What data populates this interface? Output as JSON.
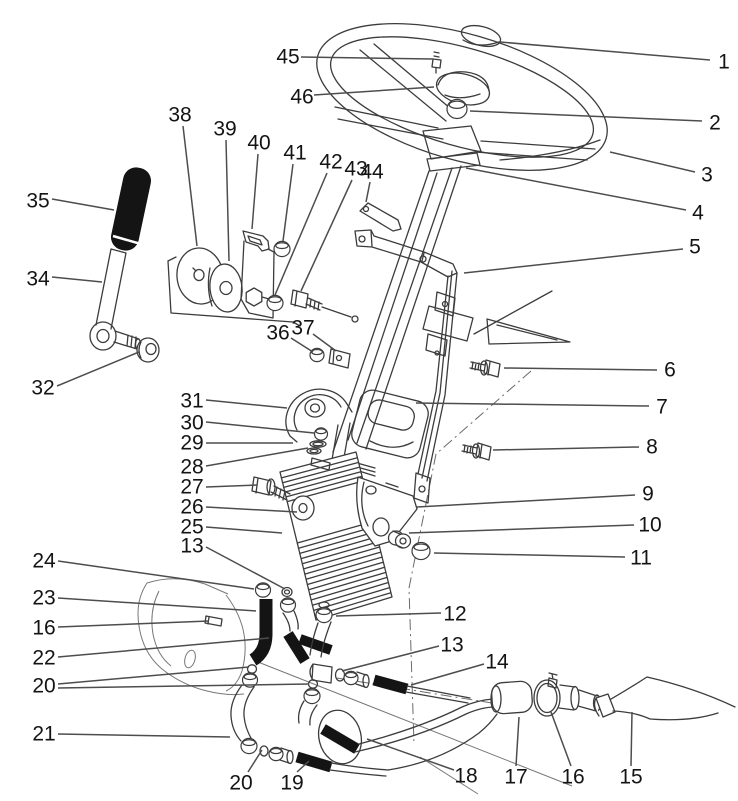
{
  "figure": {
    "type": "exploded-parts-diagram",
    "subject": "steering tower: steering wheel, tilt steering column, control valve and hydraulic hoses",
    "background": "#ffffff",
    "line_color": "#3c3c3c",
    "leader_color": "#4d4d4d",
    "label_color": "#141414",
    "ink_color": "#141414",
    "label_font_size": 21
  },
  "callouts": [
    {
      "label": "1",
      "x": 724,
      "y": 62,
      "leaders": [
        [
          500,
          42,
          710,
          60
        ]
      ]
    },
    {
      "label": "2",
      "x": 715,
      "y": 123,
      "leaders": [
        [
          470,
          111,
          702,
          121
        ]
      ]
    },
    {
      "label": "3",
      "x": 707,
      "y": 175,
      "leaders": [
        [
          610,
          152,
          695,
          172
        ]
      ]
    },
    {
      "label": "4",
      "x": 698,
      "y": 213,
      "leaders": [
        [
          466,
          168,
          686,
          210
        ]
      ]
    },
    {
      "label": "5",
      "x": 695,
      "y": 247,
      "leaders": [
        [
          464,
          273,
          683,
          249
        ]
      ]
    },
    {
      "label": "6",
      "x": 670,
      "y": 370,
      "leaders": [
        [
          504,
          368,
          657,
          370
        ]
      ]
    },
    {
      "label": "7",
      "x": 662,
      "y": 407,
      "leaders": [
        [
          416,
          403,
          649,
          406
        ]
      ]
    },
    {
      "label": "8",
      "x": 652,
      "y": 447,
      "leaders": [
        [
          493,
          450,
          639,
          447
        ]
      ]
    },
    {
      "label": "9",
      "x": 648,
      "y": 494,
      "leaders": [
        [
          417,
          507,
          635,
          495
        ]
      ]
    },
    {
      "label": "10",
      "x": 650,
      "y": 525,
      "leaders": [
        [
          409,
          533,
          634,
          525
        ]
      ]
    },
    {
      "label": "11",
      "x": 641,
      "y": 558,
      "leaders": [
        [
          434,
          553,
          625,
          557
        ]
      ]
    },
    {
      "label": "12",
      "x": 455,
      "y": 614,
      "leaders": [
        [
          336,
          616,
          441,
          613
        ]
      ]
    },
    {
      "label": "13",
      "x": 452,
      "y": 645,
      "leaders": [
        [
          342,
          671,
          439,
          646
        ]
      ]
    },
    {
      "label": "14",
      "x": 497,
      "y": 662,
      "leaders": [
        [
          411,
          685,
          484,
          664
        ]
      ]
    },
    {
      "label": "15",
      "x": 631,
      "y": 777,
      "leaders": [
        [
          632,
          712,
          631,
          766
        ]
      ]
    },
    {
      "label": "16",
      "x": 573,
      "y": 777,
      "leaders": [
        [
          551,
          712,
          571,
          766
        ]
      ]
    },
    {
      "label": "17",
      "x": 516,
      "y": 777,
      "leaders": [
        [
          519,
          717,
          516,
          766
        ]
      ]
    },
    {
      "label": "18",
      "x": 466,
      "y": 776,
      "leaders": [
        [
          367,
          739,
          454,
          770
        ]
      ]
    },
    {
      "label": "19",
      "x": 292,
      "y": 783,
      "leaders": [
        [
          309,
          761,
          297,
          772
        ]
      ]
    },
    {
      "label": "20",
      "x": 241,
      "y": 783,
      "leaders": [
        [
          262,
          750,
          248,
          772
        ]
      ]
    },
    {
      "label": "21",
      "x": 44,
      "y": 734,
      "leaders": [
        [
          230,
          737,
          58,
          734
        ]
      ]
    },
    {
      "label": "20",
      "x": 44,
      "y": 686,
      "leaders": [
        [
          249,
          667,
          58,
          684
        ],
        [
          309,
          684,
          58,
          688
        ]
      ]
    },
    {
      "label": "22",
      "x": 44,
      "y": 658,
      "leaders": [
        [
          269,
          638,
          58,
          657
        ]
      ]
    },
    {
      "label": "16",
      "x": 44,
      "y": 628,
      "leaders": [
        [
          209,
          621,
          58,
          627
        ]
      ]
    },
    {
      "label": "23",
      "x": 44,
      "y": 598,
      "leaders": [
        [
          256,
          611,
          58,
          598
        ]
      ]
    },
    {
      "label": "24",
      "x": 44,
      "y": 561,
      "leaders": [
        [
          254,
          589,
          58,
          561
        ]
      ]
    },
    {
      "label": "13",
      "x": 192,
      "y": 546,
      "leaders": [
        [
          285,
          589,
          206,
          547
        ]
      ]
    },
    {
      "label": "25",
      "x": 192,
      "y": 527,
      "leaders": [
        [
          282,
          533,
          206,
          527
        ]
      ]
    },
    {
      "label": "26",
      "x": 192,
      "y": 507,
      "leaders": [
        [
          297,
          512,
          206,
          507
        ]
      ]
    },
    {
      "label": "27",
      "x": 192,
      "y": 487,
      "leaders": [
        [
          257,
          485,
          206,
          487
        ]
      ]
    },
    {
      "label": "28",
      "x": 192,
      "y": 467,
      "leaders": [
        [
          308,
          448,
          206,
          466
        ]
      ]
    },
    {
      "label": "29",
      "x": 192,
      "y": 443,
      "leaders": [
        [
          293,
          443,
          206,
          443
        ]
      ]
    },
    {
      "label": "30",
      "x": 192,
      "y": 423,
      "leaders": [
        [
          314,
          433,
          206,
          422
        ]
      ]
    },
    {
      "label": "31",
      "x": 192,
      "y": 401,
      "leaders": [
        [
          287,
          408,
          206,
          400
        ]
      ]
    },
    {
      "label": "32",
      "x": 43,
      "y": 388,
      "leaders": [
        [
          139,
          352,
          57,
          386
        ]
      ]
    },
    {
      "label": "34",
      "x": 38,
      "y": 279,
      "leaders": [
        [
          102,
          282,
          52,
          277
        ]
      ]
    },
    {
      "label": "35",
      "x": 38,
      "y": 201,
      "leaders": [
        [
          114,
          210,
          52,
          199
        ]
      ]
    },
    {
      "label": "36",
      "x": 278,
      "y": 333,
      "leaders": [
        [
          313,
          352,
          291,
          338
        ]
      ]
    },
    {
      "label": "37",
      "x": 303,
      "y": 328,
      "leaders": [
        [
          336,
          351,
          313,
          334
        ]
      ]
    },
    {
      "label": "38",
      "x": 180,
      "y": 115,
      "leaders": [
        [
          197,
          246,
          183,
          126
        ]
      ]
    },
    {
      "label": "39",
      "x": 225,
      "y": 129,
      "leaders": [
        [
          229,
          261,
          226,
          140
        ]
      ]
    },
    {
      "label": "40",
      "x": 259,
      "y": 143,
      "leaders": [
        [
          252,
          229,
          258,
          154
        ]
      ]
    },
    {
      "label": "41",
      "x": 295,
      "y": 153,
      "leaders": [
        [
          283,
          241,
          293,
          164
        ]
      ]
    },
    {
      "label": "42",
      "x": 331,
      "y": 162,
      "leaders": [
        [
          275,
          295,
          327,
          173
        ]
      ]
    },
    {
      "label": "43",
      "x": 356,
      "y": 169,
      "leaders": [
        [
          301,
          291,
          352,
          180
        ]
      ]
    },
    {
      "label": "44",
      "x": 372,
      "y": 172,
      "leaders": [
        [
          366,
          202,
          370,
          182
        ]
      ]
    },
    {
      "label": "45",
      "x": 288,
      "y": 57,
      "leaders": [
        [
          433,
          59,
          301,
          57
        ]
      ]
    },
    {
      "label": "46",
      "x": 302,
      "y": 97,
      "leaders": [
        [
          434,
          87,
          314,
          95
        ]
      ]
    }
  ]
}
